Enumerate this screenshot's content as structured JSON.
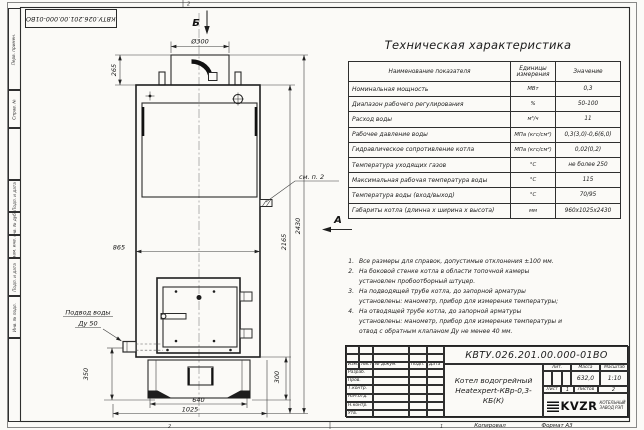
{
  "sheet": {
    "top_stamp": "КВТУ.026.201.00.000-01ВО",
    "zone_top": "2",
    "zone_bottom_left": "2",
    "zone_bottom_right": "1",
    "footer_copied": "Копировал",
    "footer_format": "Формат А3"
  },
  "margin_fields": [
    "Перв. примен.",
    "Справ. №",
    "Подп. и дата",
    "Инв. № дубл.",
    "Взам. инв. №",
    "Подп. и дата",
    "Инв. № подл."
  ],
  "drawing": {
    "view_top": "Б",
    "view_side": "А",
    "note_ref": "см. п. 2",
    "inlet_line1": "Подвод воды",
    "inlet_line2": "Ду 50",
    "dims": {
      "chimney_dia": "Ø300",
      "chimney_h": "265",
      "body_w": "865",
      "total_h": "2430",
      "body_h": "2165",
      "inlet_h": "350",
      "base_h": "300",
      "base_w": "640",
      "base_depth": "1025"
    }
  },
  "spec_table": {
    "title": "Техническая характеристика",
    "headers": [
      "Наименование показателя",
      "Единицы измерения",
      "Значение"
    ],
    "rows": [
      {
        "name": "Номинальная мощность",
        "unit": "МВт",
        "value": "0,3"
      },
      {
        "name": "Диапазон рабочего регулирования",
        "unit": "%",
        "value": "50-100"
      },
      {
        "name": "Расход воды",
        "unit": "м³/ч",
        "value": "11"
      },
      {
        "name": "Рабочее давление воды",
        "unit": "МПа (кгс/см²)",
        "value": "0,3(3,0)-0,6(6,0)"
      },
      {
        "name": "Гидравлическое сопротивление котла",
        "unit": "МПа (кгс/см²)",
        "value": "0,02(0,2)"
      },
      {
        "name": "Температура уходящих газов",
        "unit": "°С",
        "value": "не более 250"
      },
      {
        "name": "Максимальная рабочая температура воды",
        "unit": "°С",
        "value": "115"
      },
      {
        "name": "Температура воды (вход/выход)",
        "unit": "°С",
        "value": "70/95"
      },
      {
        "name": "Габариты котла (длинна х ширина х высота)",
        "unit": "мм",
        "value": "960х1025х2430"
      }
    ]
  },
  "notes": [
    {
      "num": "1.",
      "text": "Все размеры для справок, допустимые отклонения ±100 мм."
    },
    {
      "num": "2.",
      "text": "На боковой стенке котла в области топочной камеры установлен пробоотборный штуцер."
    },
    {
      "num": "3.",
      "text": "На подводящей трубе котла, до запорной арматуры установлены: манометр, прибор для измерения температуры;"
    },
    {
      "num": "4.",
      "text": "На отводящей трубе котла, до запорной арматуры установлены: манометр, прибор для измерения температуры и отвод с обратным клапаном Ду не менее 40 мм."
    }
  ],
  "title_block": {
    "doc_number": "КВТУ.026.201.00.000-01ВО",
    "name_line1": "Котел водогрейный",
    "name_line2": "Heatexpert-КВр-0,3- КБ(К)",
    "rev_headers": [
      "Изм.",
      "Лист",
      "№ докум.",
      "Подп.",
      "Дата"
    ],
    "sig_labels": [
      "Разраб.",
      "Пров.",
      "Т.контр.",
      "Нач.отд.",
      "Н.контр.",
      "Утв."
    ],
    "lit_label": "Лит.",
    "mass_label": "Масса",
    "scale_label": "Масштаб",
    "mass_value": "632,0",
    "scale_value": "1:10",
    "sheet_label": "Лист",
    "sheet_value": "1",
    "sheets_label": "Листов",
    "sheets_value": "2",
    "logo_text": "KVZR",
    "company_line1": "КОТЕЛЬНЫЙ",
    "company_line2": "ЗАВОД РЭП"
  }
}
